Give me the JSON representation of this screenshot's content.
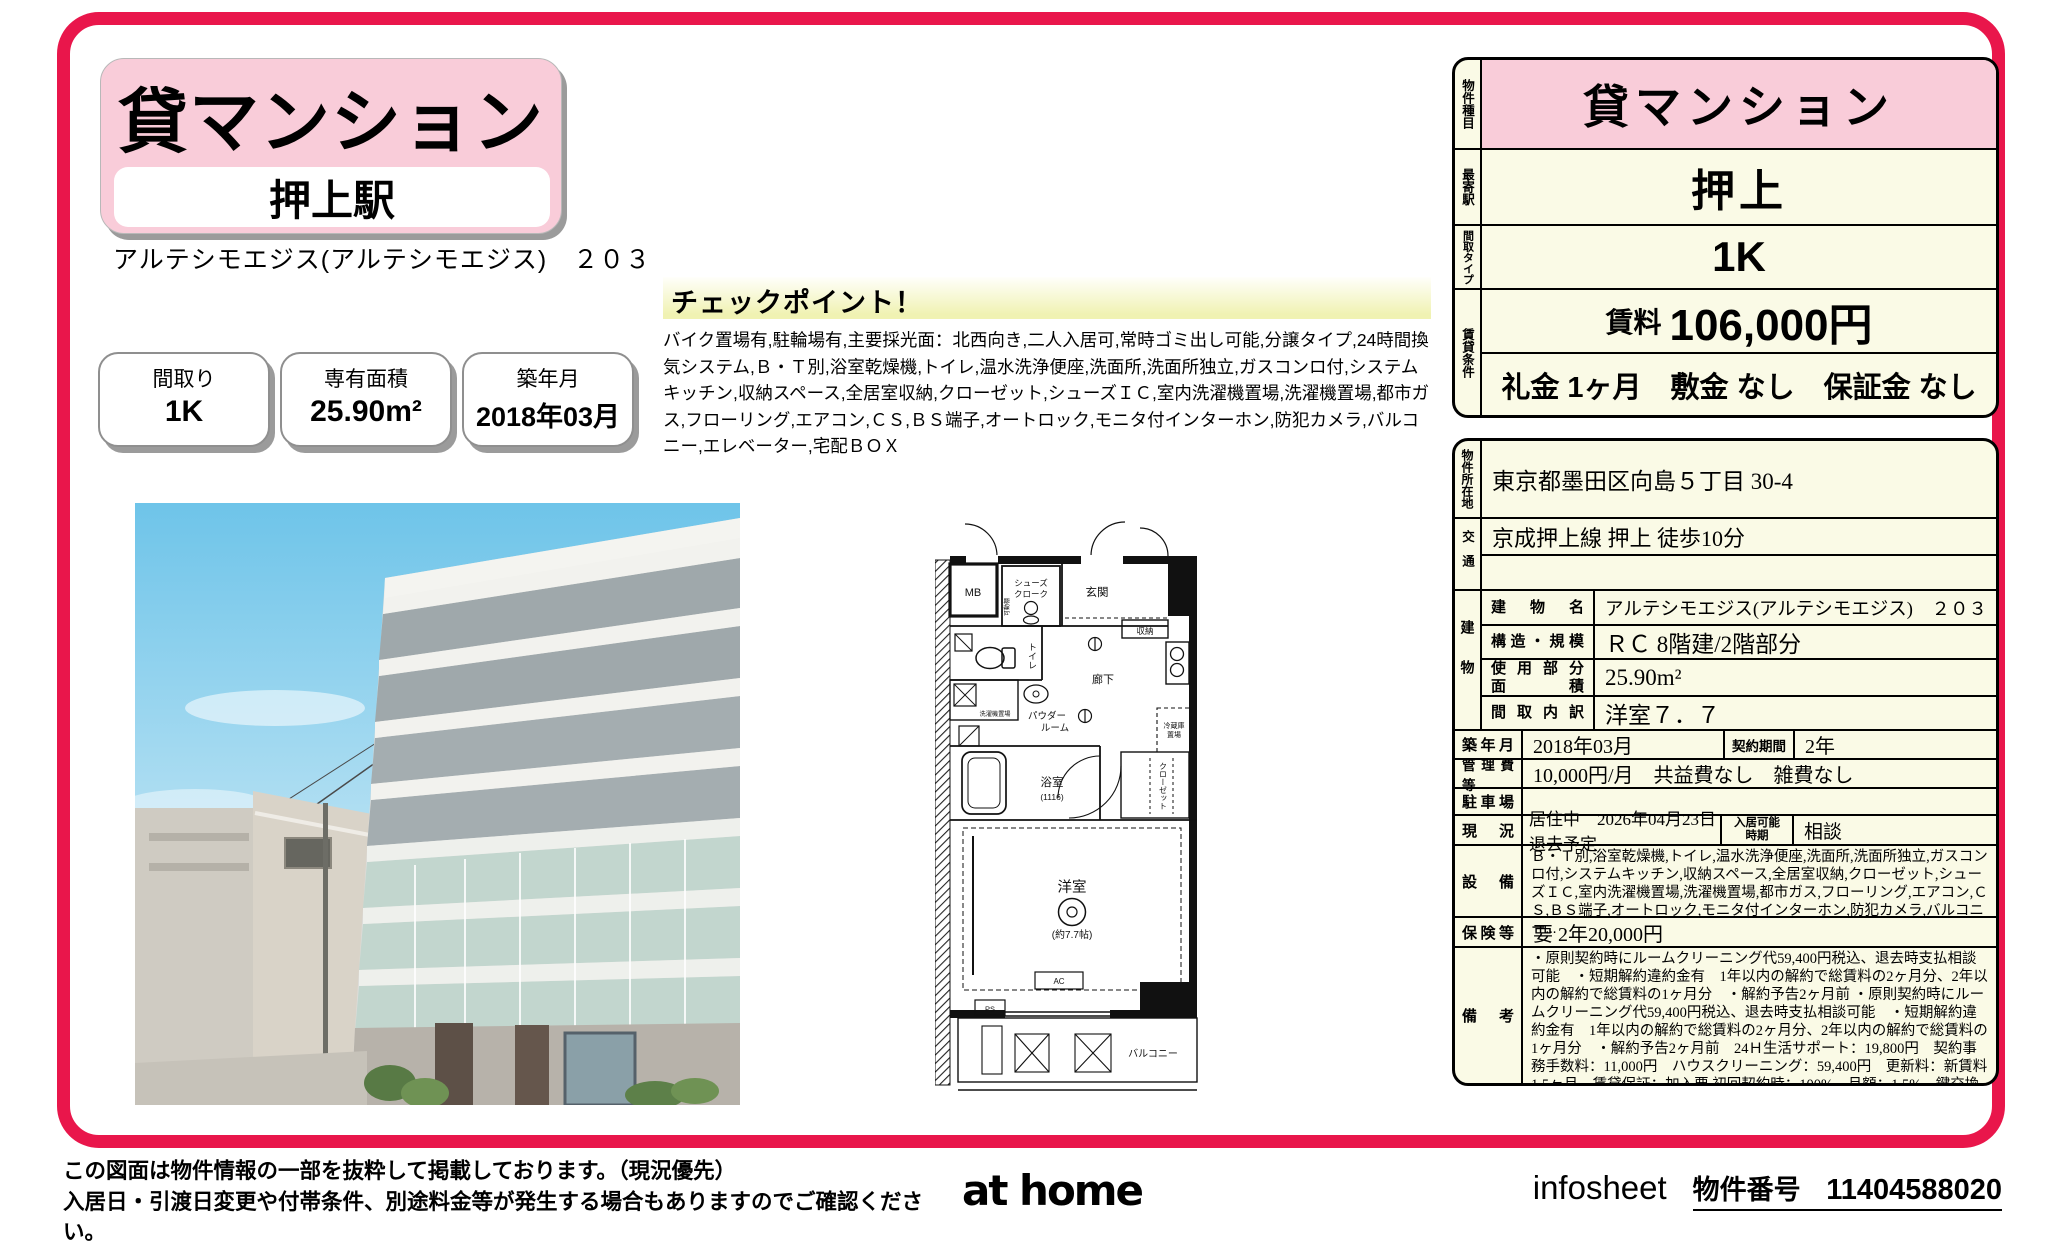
{
  "header": {
    "property_type": "貸マンション",
    "station": "押上駅",
    "building_title": "アルテシモエジス(アルテシモエジス)　２０３",
    "spec_boxes": [
      {
        "label": "間取り",
        "value": "1K"
      },
      {
        "label": "専有面積",
        "value": "25.90m²"
      },
      {
        "label": "築年月",
        "value": "2018年03月"
      }
    ]
  },
  "checkpoint": {
    "title": "チェックポイント！",
    "body": "バイク置場有,駐輪場有,主要採光面：北西向き,二人入居可,常時ゴミ出し可能,分譲タイプ,24時間換気システム,Ｂ・Ｔ別,浴室乾燥機,トイレ,温水洗浄便座,洗面所,洗面所独立,ガスコンロ付,システムキッチン,収納スペース,全居室収納,クローゼット,シューズＩＣ,室内洗濯機置場,洗濯機置場,都市ガス,フローリング,エアコン,ＣＳ,ＢＳ端子,オートロック,モニタ付インターホン,防犯カメラ,バルコニー,エレベーター,宅配ＢＯＸ"
  },
  "summary_table": {
    "property_type_label": "物件種目",
    "property_type": "貸マンション",
    "station_label": "最寄駅",
    "station": "押上",
    "layout_label": "間取タイプ",
    "layout": "1K",
    "terms_label": "賃貸条件",
    "rent_label": "賃料",
    "rent": "106,000円",
    "terms": "礼金 1ヶ月　敷金 なし　保証金 なし"
  },
  "detail_table": {
    "address_label": "物件所在地",
    "address": "東京都墨田区向島５丁目 30-4",
    "access_label": "交通",
    "access": "京成押上線 押上 徒歩10分",
    "building_label": "建物",
    "building_name_label": "建物名",
    "building_name": "アルテシモエジス(アルテシモエジス)　２０３",
    "structure_label": "構造・規模",
    "structure": "ＲＣ 8階建/2階部分",
    "area_label": "使用部分\n面　積",
    "area": "25.90m²",
    "layout_detail_label": "間取内訳",
    "layout_detail": "洋室７．７",
    "built_label": "築年月",
    "built": "2018年03月",
    "contract_label": "契約期間",
    "contract": "2年",
    "fees_label": "管理費等",
    "fees": "10,000円/月　共益費なし　雑費なし",
    "parking_label": "駐車場",
    "parking": "",
    "status_label": "現　況",
    "status": "居住中　2026年04月23日退去予定",
    "move_in_label": "入居可能\n時期",
    "move_in": "相談",
    "equipment_label": "設　備",
    "equipment": "Ｂ・Ｔ別,浴室乾燥機,トイレ,温水洗浄便座,洗面所,洗面所独立,ガスコンロ付,システムキッチン,収納スペース,全居室収納,クローゼット,シューズＩＣ,室内洗濯機置場,洗濯機置場,都市ガス,フローリング,エアコン,ＣＳ,ＢＳ端子,オートロック,モニタ付インターホン,防犯カメラ,バルコニー...",
    "insurance_label": "保険等",
    "insurance": "要 2年20,000円",
    "notes_label": "備　考",
    "notes": "・原則契約時にルームクリーニング代59,400円税込、退去時支払相談可能　・短期解約違約金有　1年以内の解約で総賃料の2ヶ月分、2年以内の解約で総賃料の1ヶ月分　・解約予告2ヶ月前 ・原則契約時にルームクリーニング代59,400円税込、退去時支払相談可能　・短期解約違約金有　1年以内の解約で総賃料の2ヶ月分、2年以内の解約で総賃料の1ヶ月分　・解約予告2ヶ月前　24Ｈ生活サポート：19,800円　契約事務手数料：11,000円　ハウスクリーニング：59,400円　更新料：新賃料 1.5ヶ月　賃貸保証：加入要 初回契約時：100%、月額：1.5%　鍵交換代等：有　27,500円～　利用駅１：東武伊勢崎・大師線 曳舟 徒歩10分　利用駅２：東武伊勢崎・大師線 とうきょうスカイツリー 徒歩12分"
  },
  "floor_plan": {
    "mb": "MB",
    "shoes_line1": "シューズ",
    "shoes_line2": "クローク",
    "shoes_shelf": "可動棚",
    "entrance": "玄関",
    "storage": "収納",
    "toilet": "トイレ",
    "hallway": "廊下",
    "powder_line1": "パウダー",
    "powder_line2": "ルーム",
    "laundry": "洗濯機置場",
    "fridge_line1": "冷蔵庫",
    "fridge_line2": "置場",
    "bath": "浴室",
    "bath_size": "(1116)",
    "closet": "クローゼット",
    "room": "洋室",
    "room_size": "(約7.7帖)",
    "ac": "AC",
    "ps": "PS",
    "balcony": "バルコニー"
  },
  "footer": {
    "disclaimer_line1": "この図面は物件情報の一部を抜粋して掲載しております。（現況優先）",
    "disclaimer_line2": "入居日・引渡日変更や付帯条件、別途料金等が発生する場合もありますのでご確認ください。",
    "logo": "at home",
    "infosheet": "infosheet",
    "property_no_label": "物件番号",
    "property_no": "11404588020"
  },
  "colors": {
    "frame": "#e9164b",
    "pink": "#f9ccd9",
    "cream": "#fafae6",
    "checkpoint_yellow": "#f0f2b2"
  }
}
